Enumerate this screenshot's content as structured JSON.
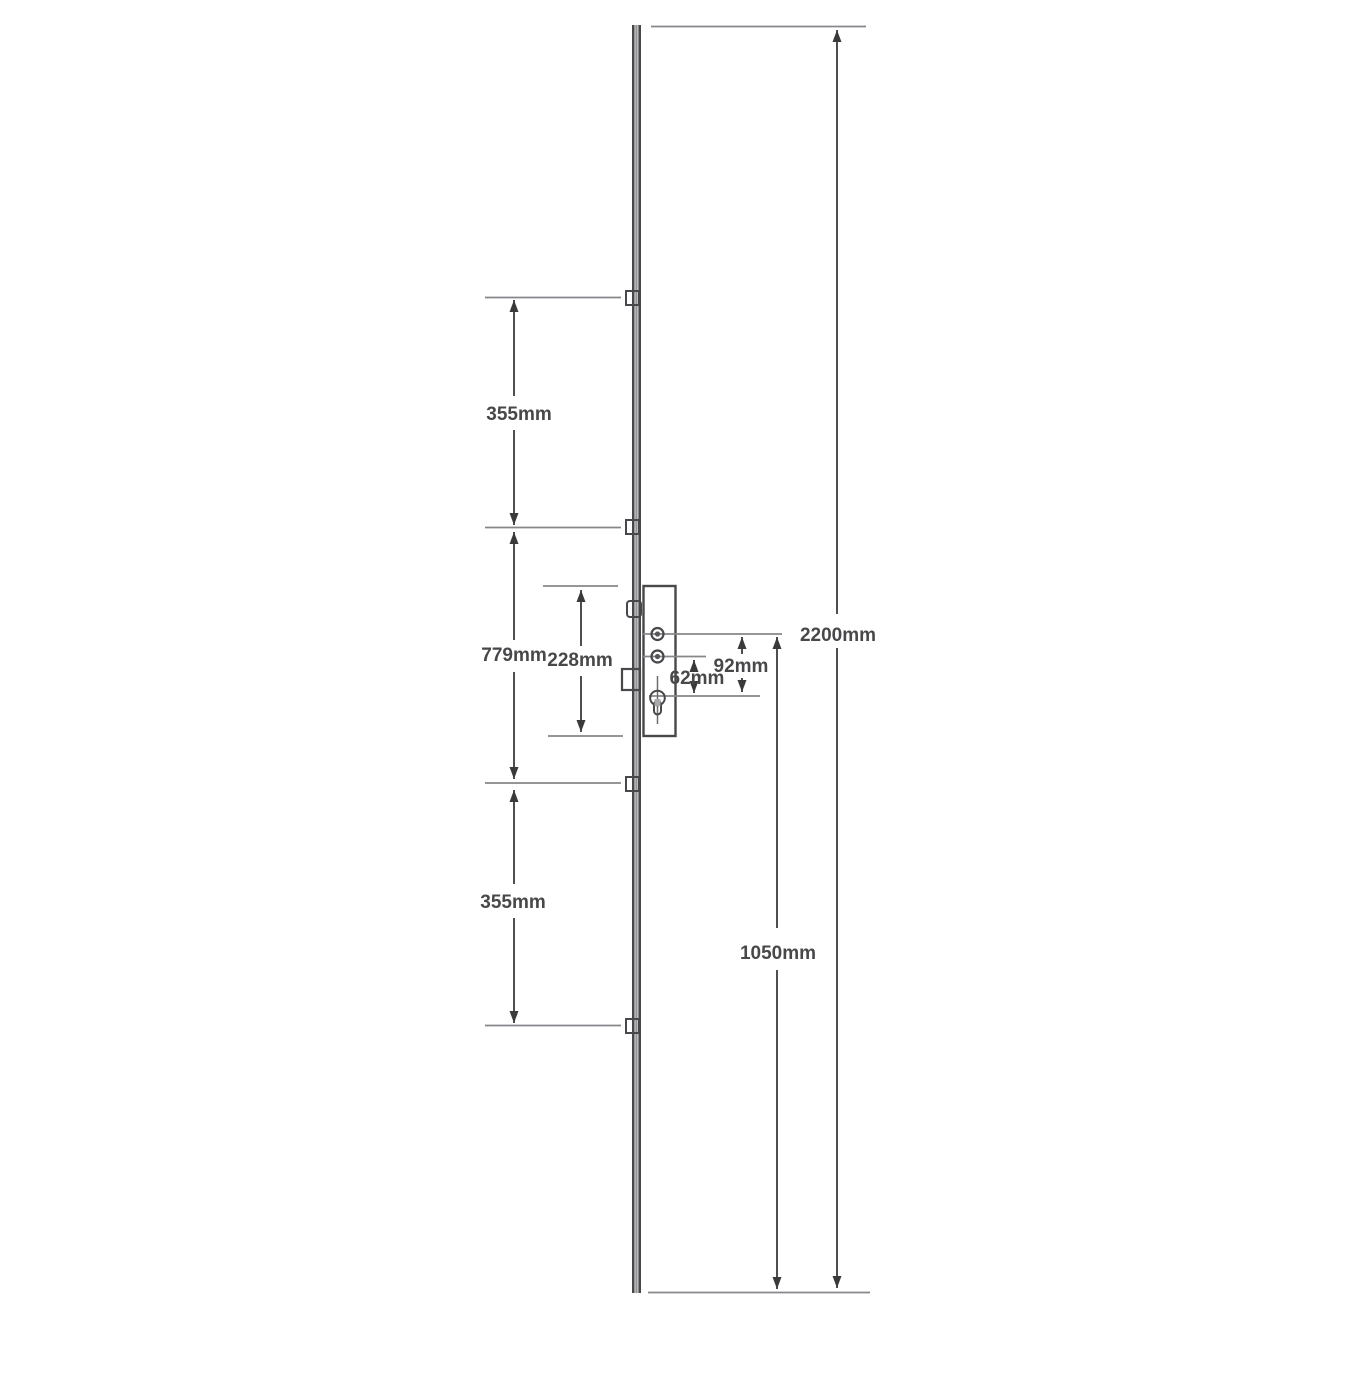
{
  "canvas": {
    "width": 1356,
    "height": 1387,
    "background": "#ffffff"
  },
  "colors": {
    "outline": "#48484a",
    "extension_line": "#85878a",
    "dimension_line": "#3a3a3c",
    "label_text": "#48484a",
    "metal_fill": "#a7a9ac"
  },
  "diagram": {
    "type": "multipoint-lock-dimension-drawing",
    "labels": {
      "dim_355_top": "355mm",
      "dim_779": "779mm",
      "dim_228": "228mm",
      "dim_62": "62mm",
      "dim_92": "92mm",
      "dim_2200": "2200mm",
      "dim_1050": "1050mm",
      "dim_355_bottom": "355mm"
    }
  }
}
